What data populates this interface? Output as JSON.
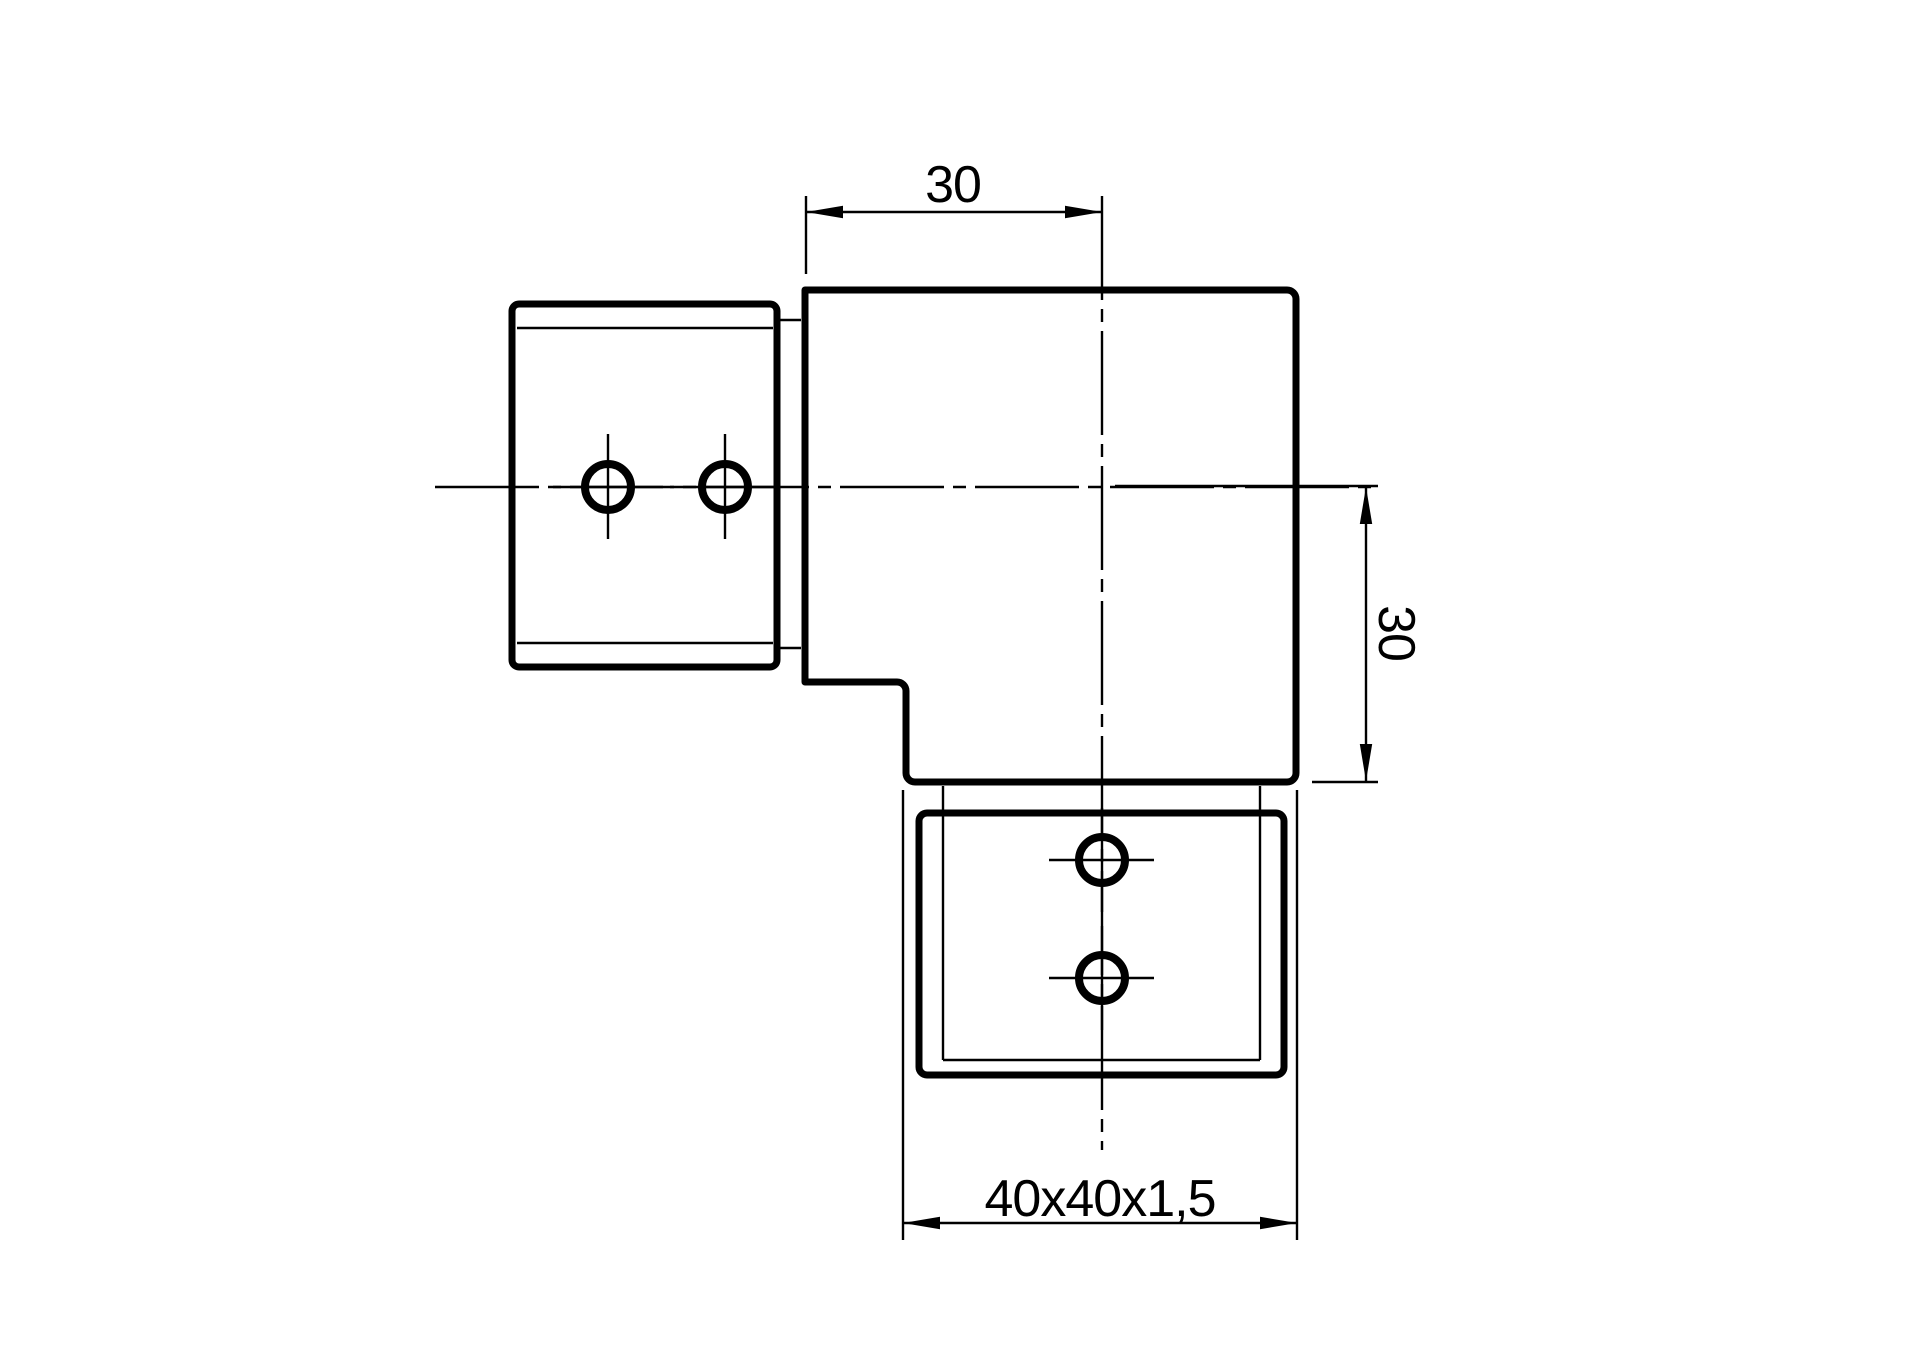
{
  "colors": {
    "background": "#ffffff",
    "line": "#000000"
  },
  "drawing": {
    "dimensions": {
      "top_width": {
        "label": "30"
      },
      "right_height": {
        "label": "30"
      },
      "bottom_tube_spec": {
        "label": "40x40x1,5"
      }
    }
  }
}
